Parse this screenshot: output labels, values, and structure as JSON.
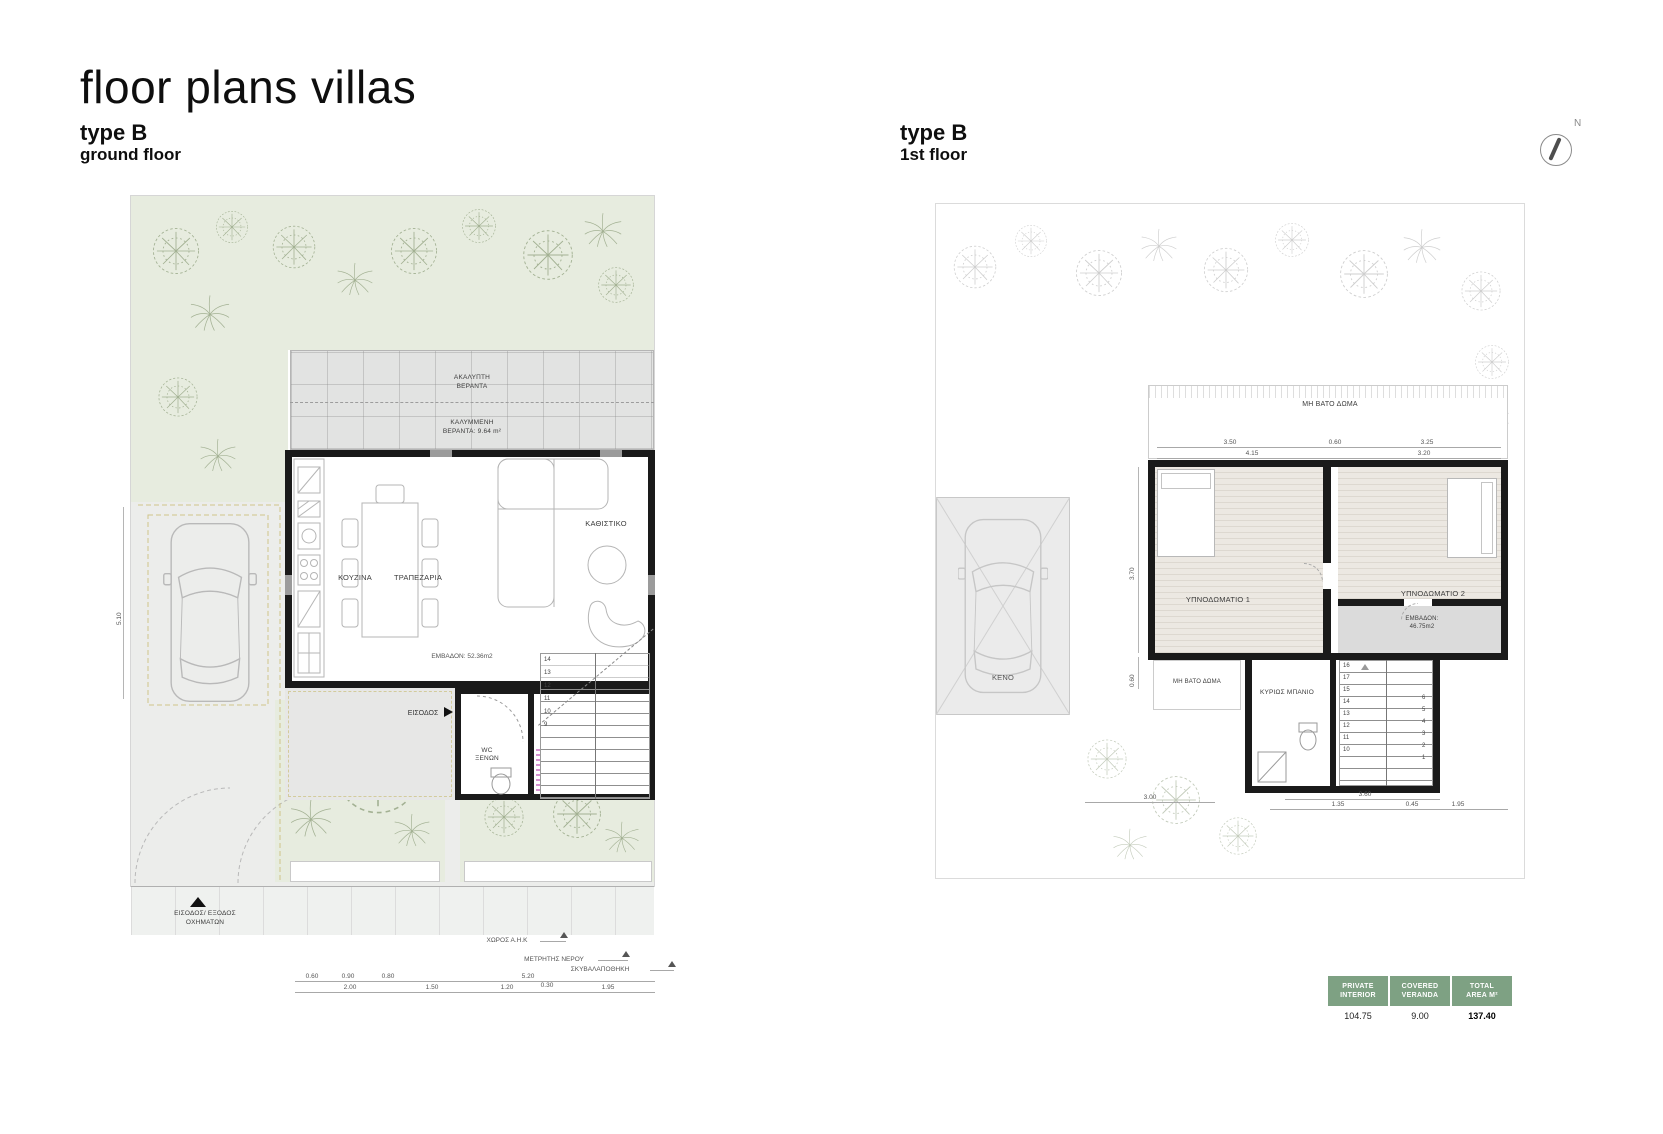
{
  "page": {
    "title": "floor plans villas"
  },
  "compass": {
    "label": "N"
  },
  "ground": {
    "type_label": "type B",
    "floor_label": "ground floor",
    "labels": {
      "veranda_open_l1": "ΑΚΑΛΥΠΤΗ",
      "veranda_open_l2": "ΒΕΡΑΝΤΑ",
      "veranda_cov_l1": "ΚΑΛΥΜΜΕΝΗ",
      "veranda_cov_l2": "ΒΕΡΑΝΤΑ: 9.64 m²",
      "kitchen": "ΚΟΥΖΙΝΑ",
      "dining": "ΤΡΑΠΕΖΑΡΙΑ",
      "living": "ΚΑΘΙΣΤΙΚΟ",
      "area": "ΕΜΒΑΔΟΝ: 52.36m2",
      "entrance": "ΕΙΣΟΔΟΣ",
      "wc_l1": "WC",
      "wc_l2": "ΞΕΝΩΝ",
      "ahk": "ΧΩΡΟΣ Α.Η.Κ",
      "water_meter": "ΜΕΤΡΗΤΗΣ ΝΕΡΟΥ",
      "garbage": "ΣΚΥΒΑΛΑΠΟΘΗΚΗ",
      "vehicle_l1": "ΕΙΣΟΔΟΣ/ ΕΞΟΔΟΣ",
      "vehicle_l2": "ΟΧΗΜΑΤΩΝ"
    },
    "dims": {
      "row1": [
        "0.60",
        "0.90",
        "0.80",
        "5.20"
      ],
      "row2": [
        "2.00",
        "1.50",
        "1.20",
        "0.30",
        "1.95"
      ],
      "vertical": "5.10"
    },
    "stair_numbers": [
      "14",
      "13",
      "12",
      "11",
      "10",
      "9"
    ]
  },
  "first": {
    "type_label": "type B",
    "floor_label": "1st floor",
    "labels": {
      "roof_top": "ΜΗ ΒΑΤΟ ΔΩΜΑ",
      "roof_low": "ΜΗ ΒΑΤΟ ΔΩΜΑ",
      "bedroom1": "ΥΠΝΟΔΩΜΑΤΙΟ 1",
      "bedroom2": "ΥΠΝΟΔΩΜΑΤΙΟ 2",
      "area_l1": "ΕΜΒΑΔΟΝ:",
      "area_l2": "46.75m2",
      "void": "ΚΕΝΟ",
      "bathroom": "ΚΥΡΙΩΣ ΜΠΑΝΙΟ"
    },
    "dims": {
      "top_row1": [
        "3.50",
        "0.60",
        "3.25"
      ],
      "top_row2": [
        "4.15",
        "3.20"
      ],
      "bottom_row1": [
        "3.60"
      ],
      "bottom_row2": [
        "1.35",
        "0.45",
        "1.95"
      ],
      "bottom_left": "3.00",
      "vertical1": "3.70",
      "vertical2": "0.60"
    },
    "stairs_left": [
      "16",
      "17",
      "15",
      "14",
      "13",
      "12",
      "11",
      "10"
    ],
    "stairs_right": [
      "6",
      "5",
      "4",
      "3",
      "2",
      "1"
    ]
  },
  "summary_table": {
    "columns": [
      {
        "header_l1": "PRIVATE",
        "header_l2": "INTERIOR",
        "value": "104.75"
      },
      {
        "header_l1": "COVERED",
        "header_l2": "VERANDA",
        "value": "9.00"
      },
      {
        "header_l1": "TOTAL",
        "header_l2": "AREA M²",
        "value": "137.40"
      }
    ]
  },
  "colors": {
    "garden_green": "#E7ECDF",
    "table_green": "#7EA183",
    "wall_black": "#1A1A1A",
    "dash_olive": "#CFC58A"
  }
}
